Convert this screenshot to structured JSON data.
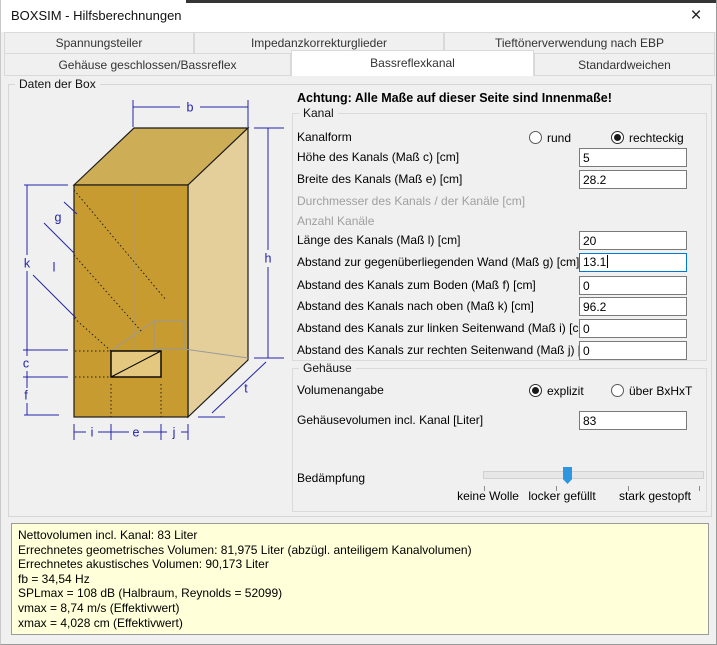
{
  "window": {
    "title": "BOXSIM - Hilfsberechnungen",
    "close_icon": "×"
  },
  "tabs": {
    "row1": [
      {
        "label": "Spannungsteiler"
      },
      {
        "label": "Impedanzkorrekturglieder"
      },
      {
        "label": "Tieftönerverwendung nach EBP"
      }
    ],
    "row2": [
      {
        "label": "Gehäuse geschlossen/Bassreflex"
      },
      {
        "label": "Bassreflexkanal",
        "active": true
      },
      {
        "label": "Standardweichen"
      }
    ]
  },
  "daten_group": {
    "legend": "Daten der Box"
  },
  "warning": "Achtung: Alle Maße auf dieser Seite sind Innenmaße!",
  "kanal": {
    "legend": "Kanal",
    "kanalform_label": "Kanalform",
    "radio_rund": "rund",
    "radio_rechteckig": "rechteckig",
    "rows": [
      {
        "label": "Höhe des Kanals (Maß c) [cm]",
        "value": "5"
      },
      {
        "label": "Breite des Kanals (Maß e) [cm]",
        "value": "28.2"
      },
      {
        "label": "Durchmesser des Kanals / der Kanäle [cm]",
        "value": ""
      },
      {
        "label": "Anzahl Kanäle",
        "value": ""
      },
      {
        "label": "Länge des Kanals (Maß l) [cm]",
        "value": "20"
      },
      {
        "label": "Abstand zur gegenüberliegenden Wand (Maß g) [cm]",
        "value": "13.1"
      },
      {
        "label": "Abstand des Kanals zum Boden (Maß f) [cm]",
        "value": "0"
      },
      {
        "label": "Abstand des Kanals nach oben (Maß k) [cm]",
        "value": "96.2"
      },
      {
        "label": "Abstand des Kanals zur linken Seitenwand (Maß i) [cm]",
        "value": "0"
      },
      {
        "label": "Abstand des Kanals zur rechten Seitenwand (Maß j) [cm]",
        "value": "0"
      }
    ]
  },
  "gehaeuse": {
    "legend": "Gehäuse",
    "volumenangabe_label": "Volumenangabe",
    "radio_explizit": "explizit",
    "radio_bxhxt": "über BxHxT",
    "volumen_label": "Gehäusevolumen incl. Kanal [Liter]",
    "volumen_value": "83",
    "bedaempfung_label": "Bedämpfung",
    "slider_labels": [
      "keine Wolle",
      "locker gefüllt",
      "stark gestopft"
    ]
  },
  "results": {
    "lines": [
      "Nettovolumen incl. Kanal: 83 Liter",
      "Errechnetes geometrisches Volumen: 81,975 Liter (abzügl. anteiligem Kanalvolumen)",
      "Errechnetes akustisches Volumen: 90,173 Liter",
      "fb = 34,54 Hz",
      "SPLmax = 108 dB (Halbraum, Reynolds = 52099)",
      "vmax = 8,74 m/s (Effektivwert)",
      "xmax = 4,028 cm (Effektivwert)"
    ]
  },
  "diagram": {
    "labels": {
      "b": "b",
      "h": "h",
      "k": "k",
      "g": "g",
      "l": "l",
      "c": "c",
      "f": "f",
      "i": "i",
      "e": "e",
      "j": "j",
      "t": "t"
    }
  },
  "colors": {
    "box_front": "#C79B2F",
    "box_top": "#CDAD56",
    "box_side": "#E4CF9B",
    "port_fill": "#E5C87F",
    "dimension_blue": "#2323A8",
    "slider_thumb": "#2E96E0",
    "focus_border": "#0078D7",
    "results_bg": "#FFFFD9"
  }
}
